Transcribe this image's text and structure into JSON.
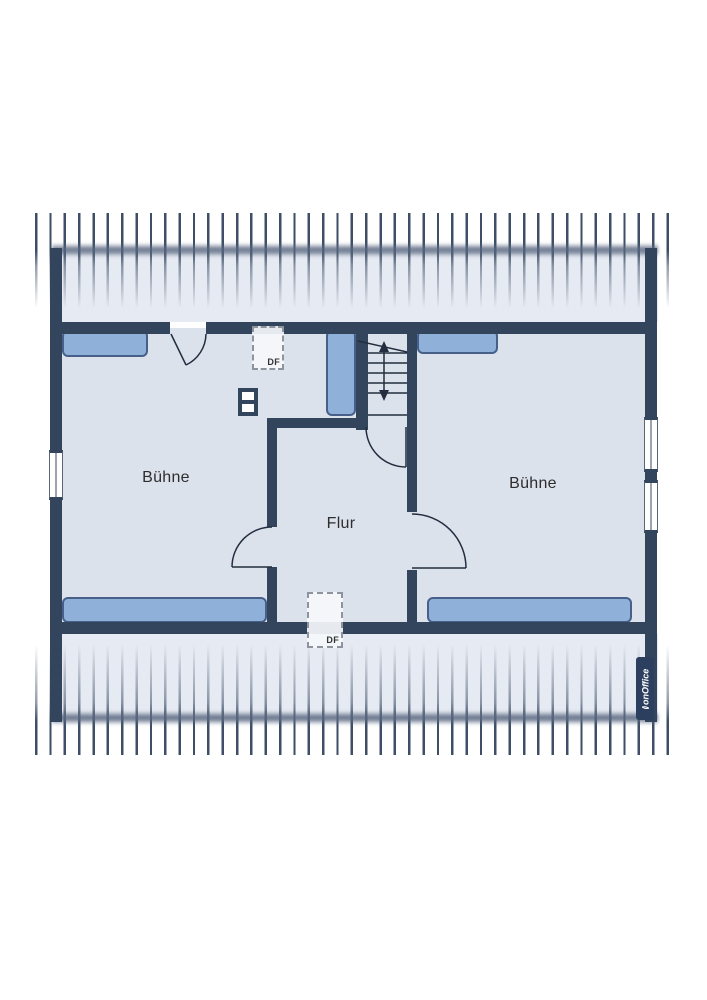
{
  "floorplan": {
    "rooms": [
      {
        "id": "buehne-left",
        "label": "Bühne"
      },
      {
        "id": "flur",
        "label": "Flur"
      },
      {
        "id": "buehne-right",
        "label": "Bühne"
      }
    ],
    "skylights": [
      {
        "id": "skylight-top",
        "label": "DF"
      },
      {
        "id": "skylight-bottom",
        "label": "DF"
      }
    ],
    "watermark": {
      "brand": "onOffice"
    },
    "colors": {
      "wall": "#33455c",
      "floor": "#dce2ec",
      "band": "#e6eaf2",
      "hatch": "#3d4e66",
      "furniture_fill": "#8fb0d9",
      "furniture_border": "#47608a",
      "line": "#222e3f",
      "dash": "#8d949e",
      "label": "#2d2d2d",
      "logo_bg": "#2c3f5e",
      "window_frame": "#5a6675"
    }
  }
}
